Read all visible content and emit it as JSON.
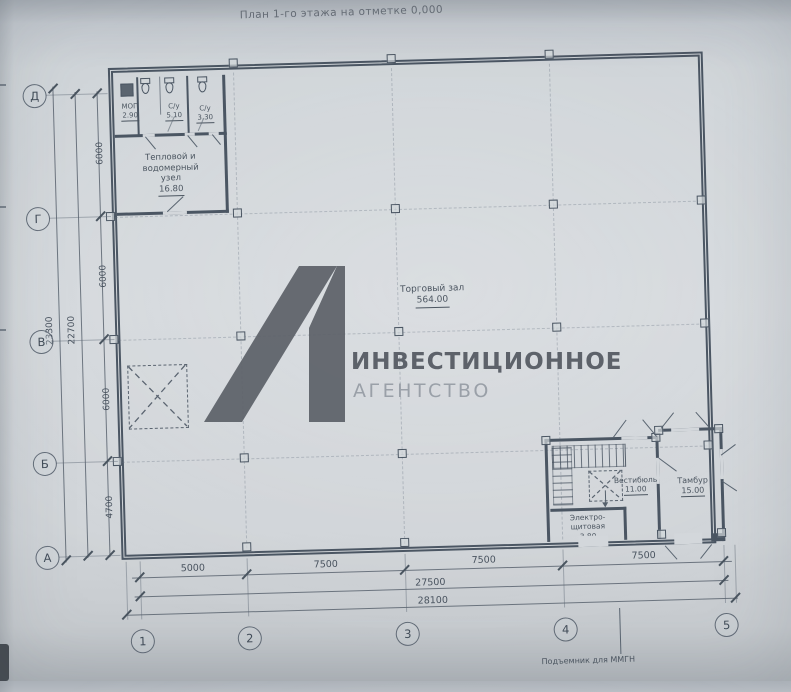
{
  "title": "План 1-го этажа на отметке 0,000",
  "watermark": {
    "brand_line1": "ИНВЕСТИЦИОННОЕ",
    "brand_line2": "АГЕНТСТВО"
  },
  "grid": {
    "rows": [
      "Д",
      "Г",
      "В",
      "Б",
      "А"
    ],
    "cols": [
      "1",
      "2",
      "3",
      "4",
      "5"
    ]
  },
  "dims": {
    "left": [
      "6000",
      "6000",
      "6000",
      "4700"
    ],
    "left_inner": "22700",
    "left_outer": "23300",
    "bottom": [
      "5000",
      "7500",
      "7500",
      "7500"
    ],
    "bottom_inner": "27500",
    "bottom_outer": "28100"
  },
  "rooms": {
    "mop": {
      "name": "МОП",
      "area": "2.90"
    },
    "wc1": {
      "name": "С/у",
      "area": "5.10"
    },
    "wc2": {
      "name": "С/у",
      "area": "3.30"
    },
    "heat": {
      "l1": "Тепловой и",
      "l2": "водомерный",
      "l3": "узел",
      "area": "16.80"
    },
    "hall": {
      "name": "Торговый зал",
      "area": "564.00"
    },
    "vest": {
      "name": "Вестибюль",
      "area": "11.00"
    },
    "electro": {
      "l1": "Электро-",
      "l2": "щитовая",
      "area": "3.80"
    },
    "tambour": {
      "name": "Тамбур",
      "area": "15.00"
    }
  },
  "note": "Подъемник для ММГН",
  "colors": {
    "ink": "#4b5663",
    "paper": "#d3d7db",
    "watermark_dark": "#5c6168",
    "watermark_light": "#9aa0a8"
  }
}
